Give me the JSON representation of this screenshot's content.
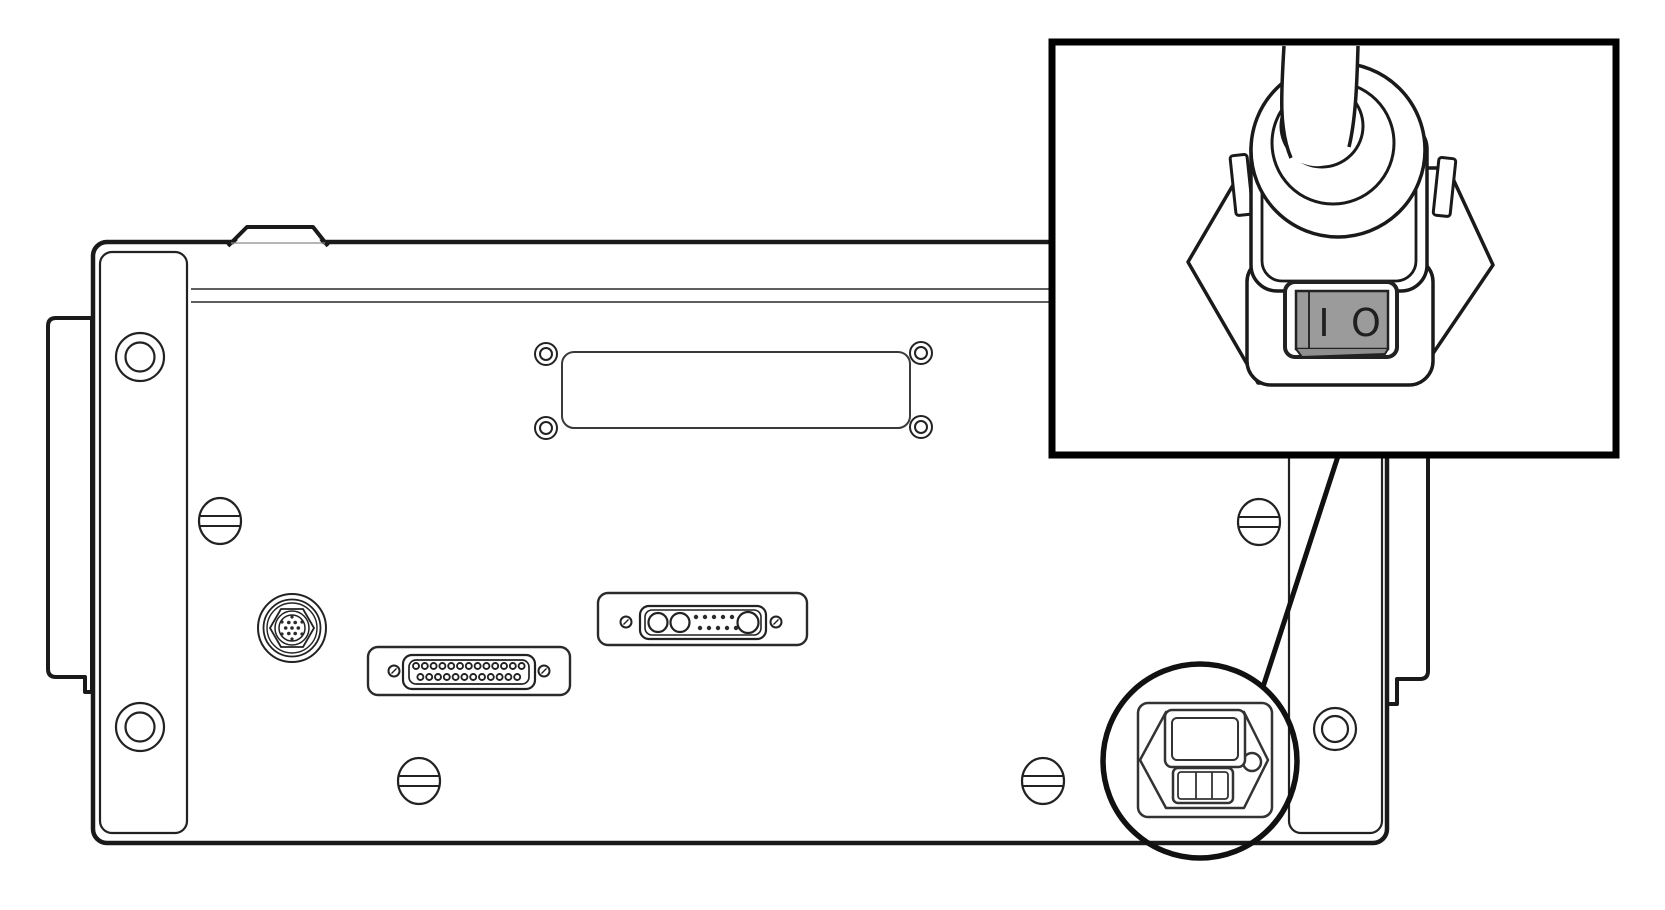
{
  "diagram": {
    "type": "technical-line-illustration",
    "subject": "rear-panel-of-instrument-with-power-cord-callout",
    "background_color": "#ffffff",
    "line_color": "#1a1a1a",
    "inset": {
      "border_color": "#000000",
      "subject": "power-cord-plug-with-rocker-switch",
      "power_switch": {
        "on_mark": "I",
        "off_mark": "O",
        "rocker_color": "#9b9b9b"
      }
    },
    "parts": [
      "chassis-rear-panel",
      "top-handle-bump",
      "left-mounting-bracket",
      "right-mounting-bracket",
      "left-side-flange",
      "right-side-flange",
      "bracket-hole",
      "slotted-screw",
      "blank-cover-plate",
      "cover-plate-screw",
      "circular-din-connector",
      "db25-connector",
      "combo-dsub-connector",
      "power-inlet-module",
      "callout-circle",
      "callout-leader-line",
      "power-cord-cable",
      "plug-strain-relief-boot",
      "plug-retaining-clips",
      "rocker-power-switch"
    ]
  }
}
